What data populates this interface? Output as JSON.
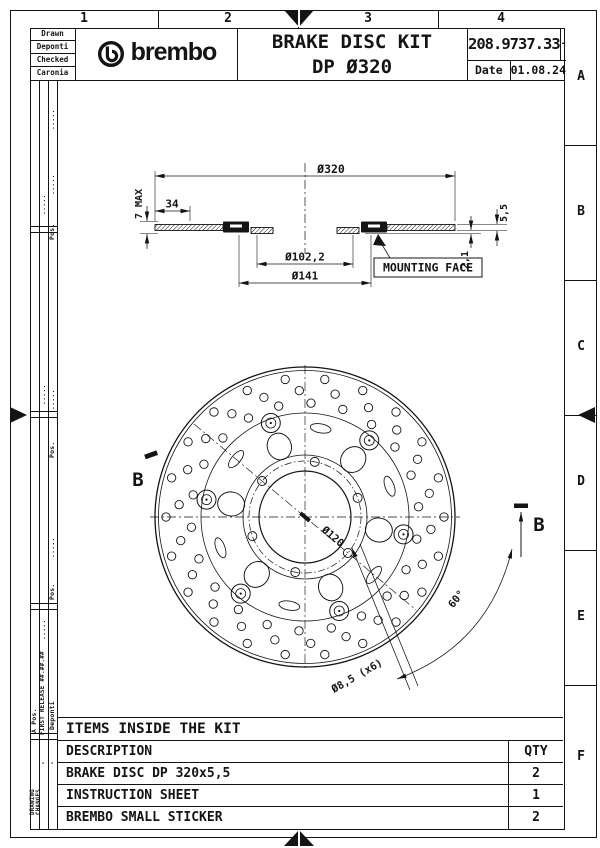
{
  "page": {
    "ink": "#141414",
    "paper": "#ffffff"
  },
  "grid_refs": {
    "columns": [
      "1",
      "2",
      "3",
      "4"
    ],
    "rows": [
      "A",
      "B",
      "C",
      "D",
      "E",
      "F"
    ]
  },
  "title_block": {
    "approvals": [
      "Drawn",
      "Deponti",
      "Checked",
      "Caronia"
    ],
    "logo_text": "brembo",
    "title_line1": "BRAKE DISC KIT",
    "title_line2": "DP Ø320",
    "part_number": "208.9737.33",
    "revision": "-",
    "date_label": "Date",
    "date_value": "01.08.24"
  },
  "revision_strip": {
    "changes_line1": "DRAWING",
    "changes_line2": "CHANGES",
    "a_pos": "A Pos.",
    "dash": "-",
    "first_release": "FIRST RELEASE ##.##.##",
    "author": "Deponti",
    "pos_label": "Pos.",
    "dots": "....."
  },
  "drawing": {
    "section": {
      "dia_outer": "Ø320",
      "band_width": "34",
      "thickness_max": "7 MAX",
      "dia_inner": "Ø102,2",
      "dia_flange": "Ø141",
      "mounting_face": "MOUNTING FACE",
      "thickness": "5,5",
      "offset": "2,1"
    },
    "front": {
      "dia_bolt_circle": "Ø120",
      "angle": "60°",
      "holes": "Ø8,5 (x6)",
      "section_letter": "B",
      "bolt_hole_count": 6,
      "bobbin_count": 6,
      "drill_rings": [
        {
          "radius": 139,
          "count": 22
        },
        {
          "radius": 126.5,
          "count": 22
        },
        {
          "radius": 114,
          "count": 22
        }
      ]
    }
  },
  "items_table": {
    "title": "ITEMS INSIDE THE KIT",
    "col_description": "DESCRIPTION",
    "col_qty": "QTY",
    "rows": [
      {
        "description": "BRAKE DISC DP 320x5,5",
        "qty": "2"
      },
      {
        "description": "INSTRUCTION SHEET",
        "qty": "1"
      },
      {
        "description": "BREMBO SMALL STICKER",
        "qty": "2"
      }
    ]
  }
}
